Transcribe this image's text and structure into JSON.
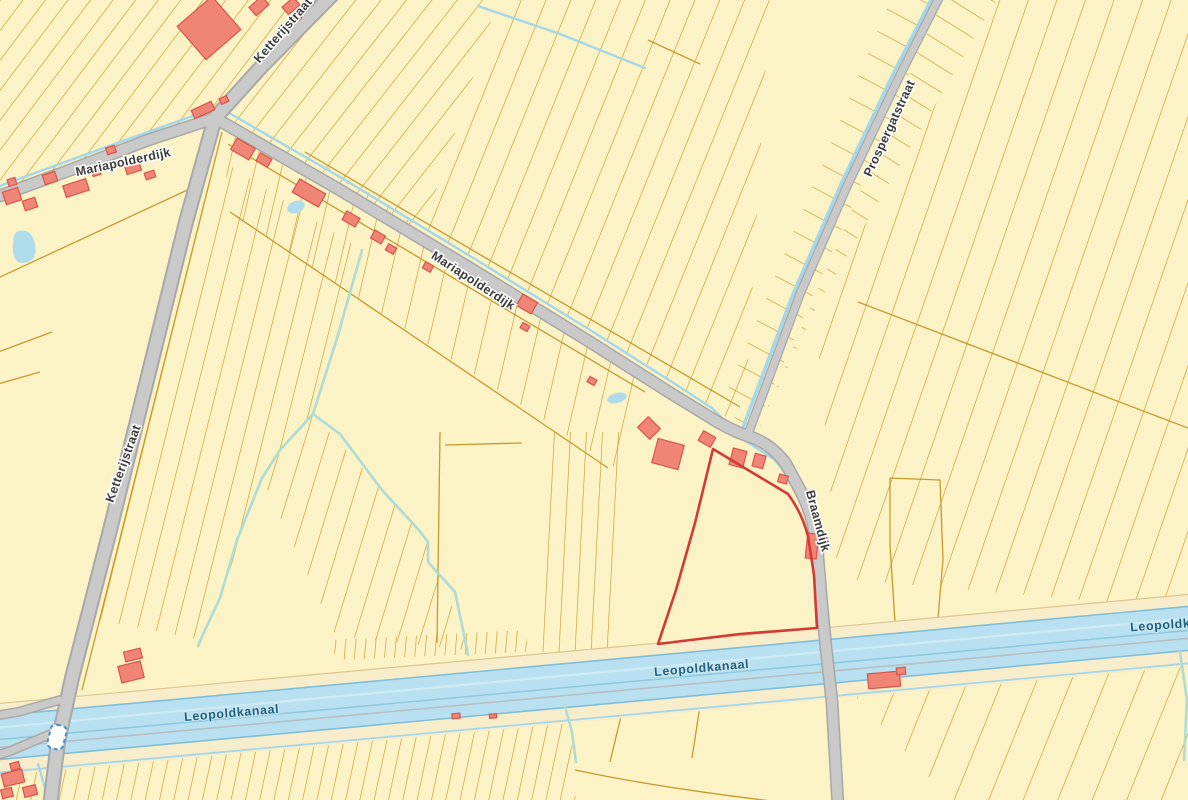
{
  "map": {
    "description": "Cadastral parcel map around Leopoldkanaal",
    "street_labels": [
      {
        "text": "Mariapolderdijk"
      },
      {
        "text": "Ketterijstraat"
      },
      {
        "text": "Mariapolderdijk"
      },
      {
        "text": "Prospergatstraat"
      },
      {
        "text": "Ketterijstraat"
      },
      {
        "text": "Braamdijk"
      }
    ],
    "water_labels": [
      {
        "text": "Leopoldkanaal"
      },
      {
        "text": "Leopoldkanaal"
      },
      {
        "text": "Leopoldkanaal"
      }
    ],
    "icons": {
      "bridge": "bridge-crossing-icon"
    },
    "colors": {
      "background": "#FBF2C5",
      "parcel_line": "#C49B2F",
      "road_fill": "#C9C9C9",
      "road_casing": "#A8A8A8",
      "water_fill": "#B9E0F0",
      "water_edge": "#7FBED8",
      "water_streak_light": "#CFEAF5",
      "water_streak_dark": "#8FC9DE",
      "water_gray_line": "#B7BFC2",
      "pond_fill": "#AEDCEA",
      "ditch_blue": "#A4D7EA",
      "ditch_green": "#AFDCD2",
      "towpath_fill": "#F7EDCB",
      "towpath_line": "#D9C891",
      "building_fill": "#F08576",
      "building_stroke": "#D9544A",
      "highlight_stroke": "#D23B35",
      "street_label": "#3B3B3B",
      "water_label": "#20607D",
      "bridge_stroke": "#4A90C4"
    }
  }
}
